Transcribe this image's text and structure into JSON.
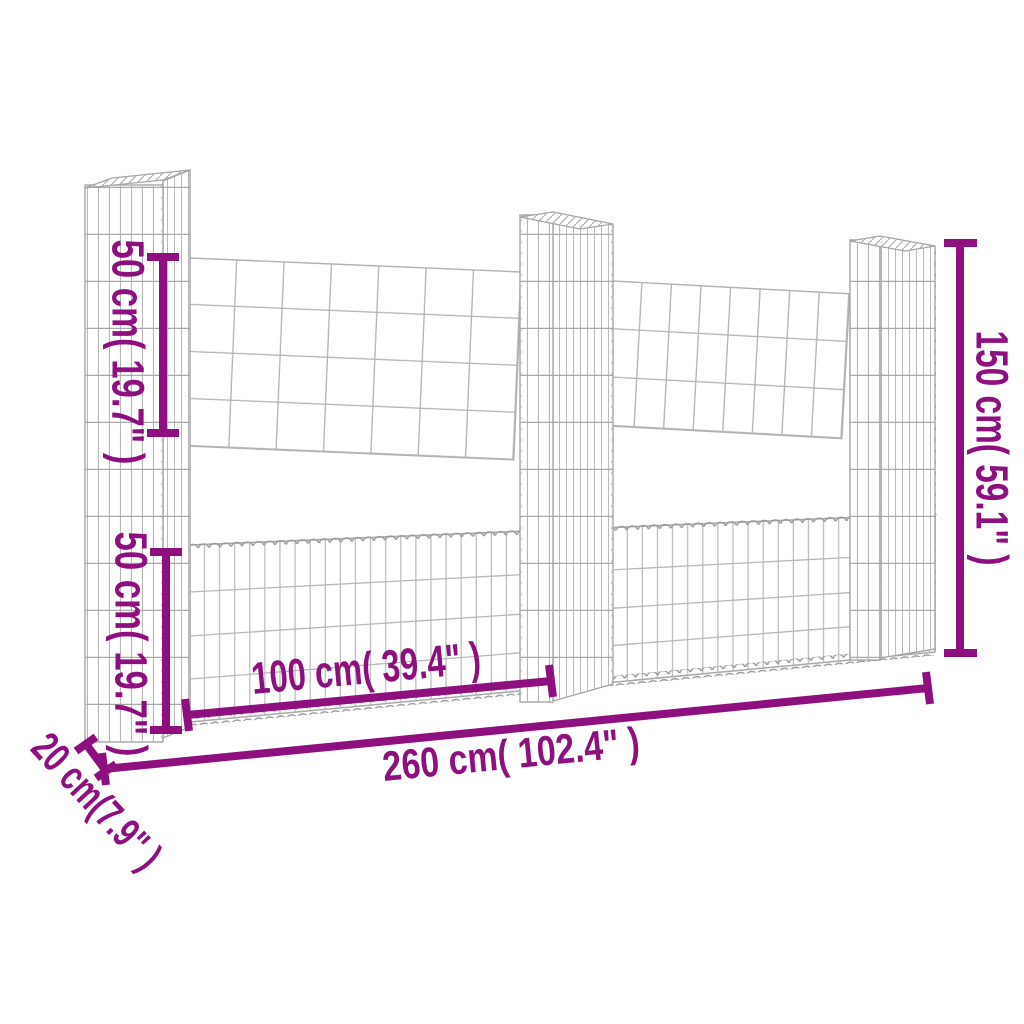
{
  "figure": {
    "kind": "product-dimension-diagram",
    "subject": "U-shaped gabion basket wall with three wire-mesh posts and lower stone baskets",
    "posts_count": 3
  },
  "colors": {
    "accent": "#8E107F",
    "wire_light": "#bdbdbd",
    "wire_mid": "#b0b0b0",
    "wire_dark": "#9a9a9a",
    "background": "#ffffff"
  },
  "dimensions": {
    "upper_section_height": {
      "cm": 50,
      "inches": 19.7,
      "label": "50 cm( 19.7\" )"
    },
    "basket_height": {
      "cm": 50,
      "inches": 19.7,
      "label": "50 cm( 19.7\" )"
    },
    "total_height": {
      "cm": 150,
      "inches": 59.1,
      "label": "150 cm( 59.1\" )"
    },
    "section_width": {
      "cm": 100,
      "inches": 39.4,
      "label": "100 cm( 39.4\" )"
    },
    "total_width": {
      "cm": 260,
      "inches": 102.4,
      "label": "260 cm( 102.4\" )"
    },
    "depth": {
      "cm": 20,
      "inches": 7.9,
      "label": "20 cm(7.9\" )"
    }
  }
}
